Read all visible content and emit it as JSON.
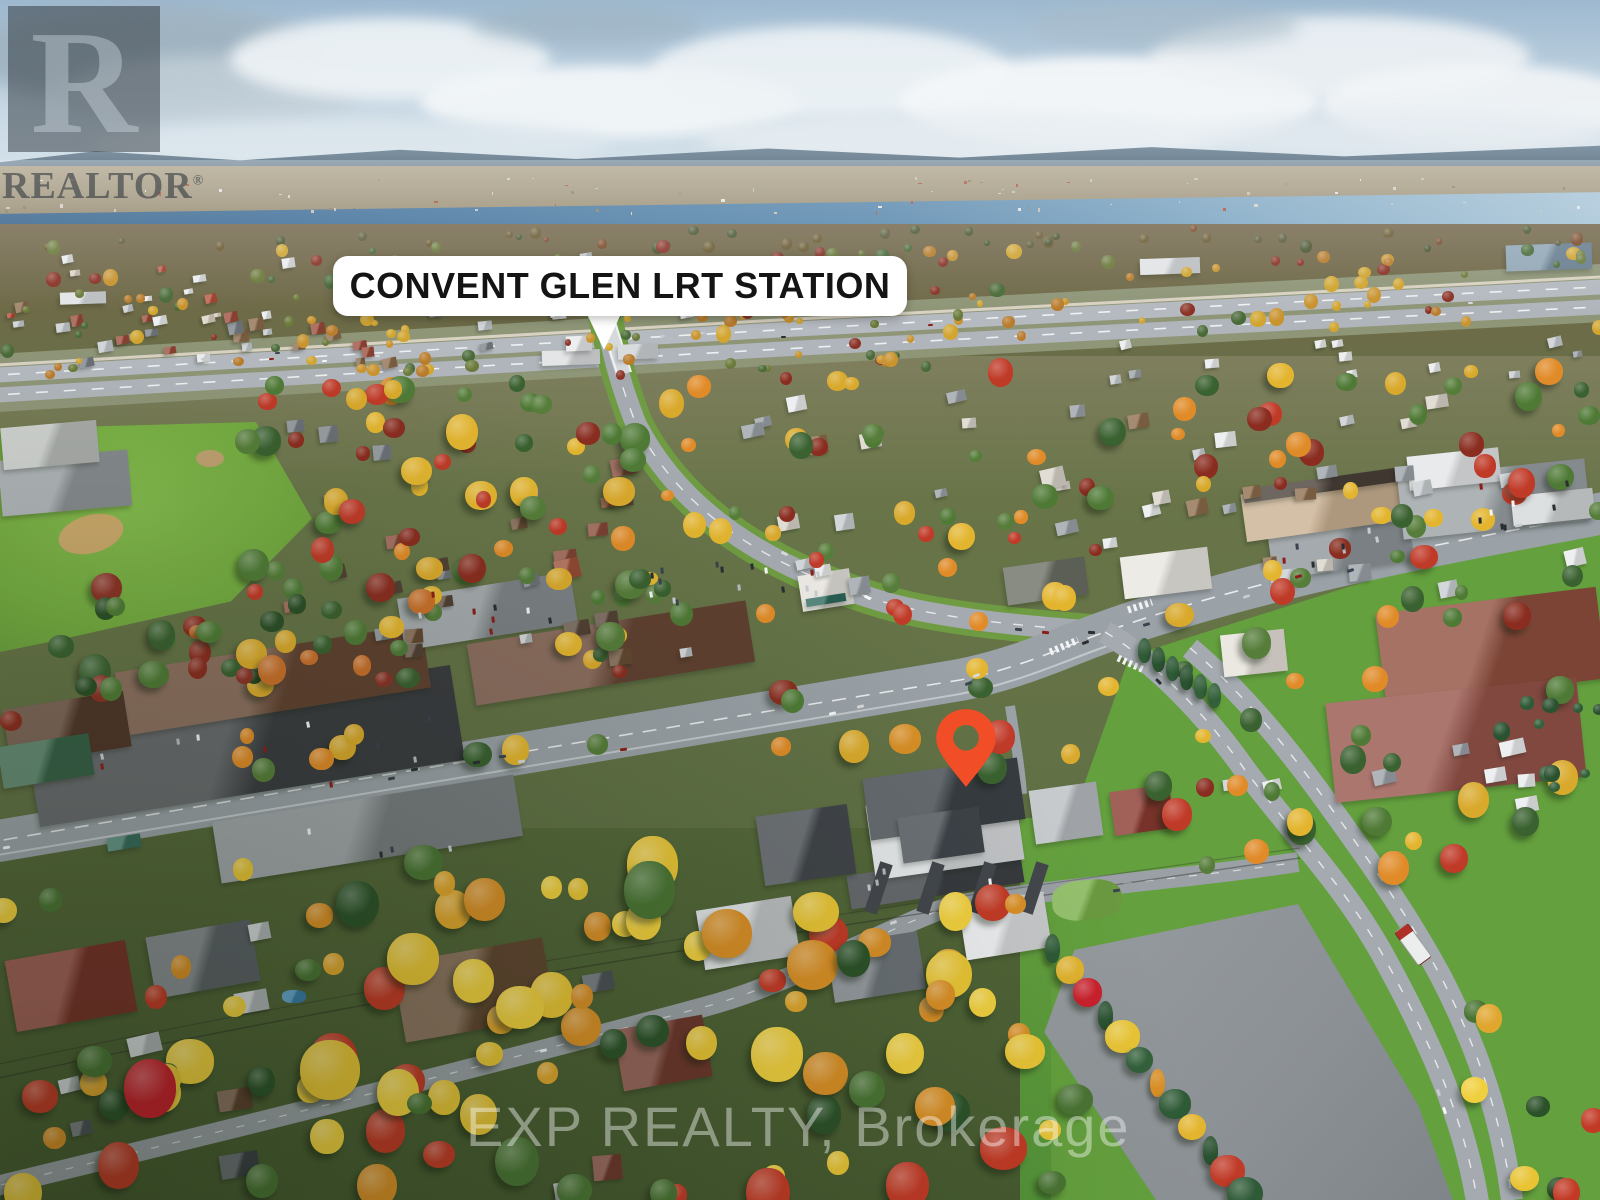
{
  "annotations": {
    "station_callout": {
      "label": "CONVENT GLEN LRT STATION",
      "background": "#FFFFFF",
      "text_color": "#141414"
    },
    "location_pin": {
      "color": "#F14D26"
    }
  },
  "watermarks": {
    "realtor": {
      "logo_letter": "R",
      "wordmark": "REALTOR",
      "registered_mark": "®"
    },
    "brokerage": {
      "text": "EXP REALTY, Brokerage"
    }
  },
  "scene_palette": {
    "sky": "#B7CCDD",
    "river": "#3A6D96",
    "autumn_yellow": "#E3B52F",
    "autumn_orange": "#D98B28",
    "autumn_red": "#C0392B",
    "grass": "#74AB41",
    "road": "#9AA1A7"
  }
}
